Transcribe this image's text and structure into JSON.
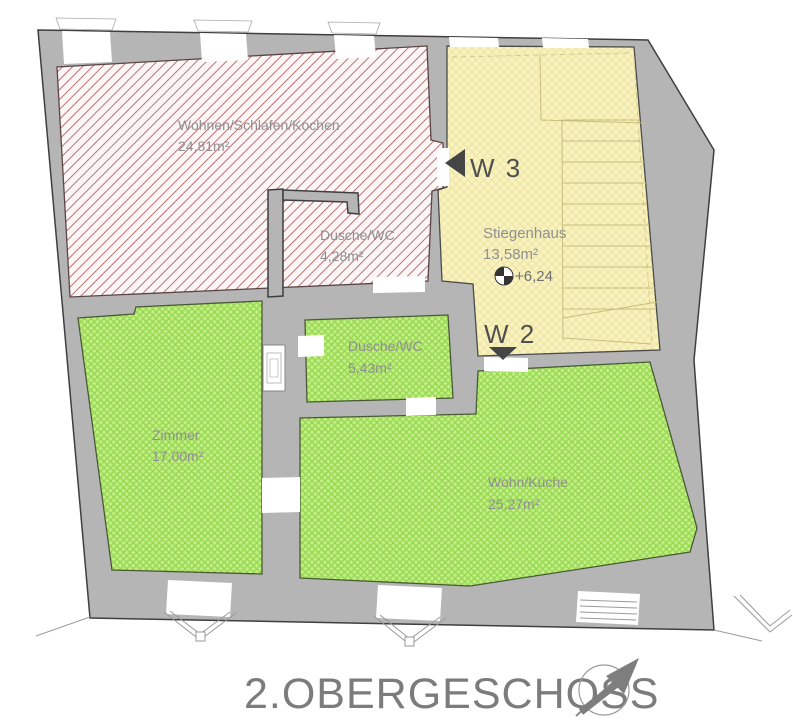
{
  "plan": {
    "title": "2.OBERGESCHOSS",
    "labels": {
      "unit_w3": "W 3",
      "unit_w2": "W 2",
      "level": "+6,24"
    },
    "rooms": [
      {
        "name": "Wohnen/Schlafen/Kochen",
        "area": "24,81m²",
        "unit": "W 3",
        "fill": "red-hatch"
      },
      {
        "name": "Dusche/WC",
        "area": "4,28m²",
        "unit": "W 3",
        "fill": "red-hatch"
      },
      {
        "name": "Stiegenhaus",
        "area": "13,58m²",
        "unit": "common",
        "fill": "yellow-hatch"
      },
      {
        "name": "Zimmer",
        "area": "17,00m²",
        "unit": "W 2",
        "fill": "green-hatch"
      },
      {
        "name": "Dusche/WC",
        "area": "5,43m²",
        "unit": "W 2",
        "fill": "green-hatch"
      },
      {
        "name": "Wohn/Küche",
        "area": "25,27m²",
        "unit": "W 2",
        "fill": "green-hatch"
      }
    ],
    "icons": {
      "north_arrow": "north-arrow",
      "level_marker": "surveyor-level-marker",
      "w3_door_arrow": "door-arrow-left",
      "w2_door_arrow": "door-arrow-down"
    },
    "colors": {
      "wall": "#b5b5b5",
      "wall_outline": "#3f3f3f",
      "red_hatch_line": "#b05c5c",
      "red_bg": "#fdf6f6",
      "green_bg": "#c3ec84",
      "green_hatch_line": "#92d94e",
      "yellow_bg": "#f8f2bf",
      "yellow_hatch_line": "#ede2a0",
      "label_text": "#8f8f8f",
      "unit_text": "#4f4f4f",
      "title_text": "#7c7c7c"
    }
  }
}
